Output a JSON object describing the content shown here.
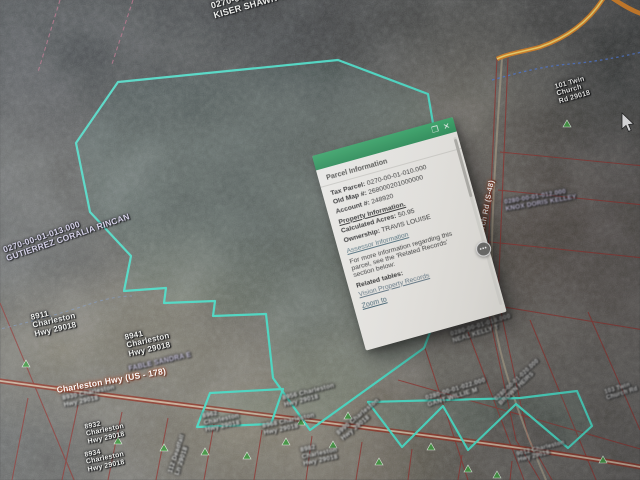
{
  "popup": {
    "title": "Parcel Information",
    "dock_icon": "❐",
    "close_icon": "✕",
    "rows": [
      {
        "label": "Tax Parcel:",
        "value": "0270-00-01-010.000"
      },
      {
        "label": "Old Map #:",
        "value": "268000201000000"
      },
      {
        "label": "Account #:",
        "value": "248920"
      }
    ],
    "property_heading": "Property Information.",
    "property_rows": [
      {
        "label": "Calculated Acres:",
        "value": "50.95"
      },
      {
        "label": "Ownership:",
        "value": "TRAVIS LOUISE"
      }
    ],
    "assessor_link": "Assessor Information",
    "note": "For more information regarding this parcel, see the 'Related Records' section below:",
    "related_heading": "Related tables:",
    "related_link": "Vision Property Records",
    "zoom_to_link": "Zoom to",
    "more_options_icon": "•••"
  },
  "map": {
    "colors": {
      "selected_parcel": "#3de3c9",
      "parcel_line": "#9c3530",
      "road_orange": "#e0811d",
      "marker_green": "#3f9e3e",
      "owner_label_purple": "#d9d2ee"
    },
    "labels": [
      {
        "lines": [
          "0270-00-01-004.000",
          "KISER SHAWN CAMPBELL"
        ]
      },
      {
        "lines": [
          "0270-00-01-013.000",
          "GUTIERREZ CORALIA RINCAN"
        ]
      },
      {
        "lines": [
          "8911",
          "Charleston",
          "Hwy 29018"
        ]
      },
      {
        "lines": [
          "8941",
          "Charleston",
          "Hwy 29018"
        ]
      },
      {
        "lines": [
          "FABLE SANDRA E"
        ]
      },
      {
        "lines": [
          "Charleston Hwy (US - 178)"
        ]
      },
      {
        "lines": [
          "8930 Charleston",
          "Hwy 29018"
        ]
      },
      {
        "lines": [
          "8932",
          "Charleston",
          "Hwy 29018"
        ]
      },
      {
        "lines": [
          "8934",
          "Charleston",
          "Hwy 29018"
        ]
      },
      {
        "lines": [
          "112 Deadfall",
          "Ln 29018"
        ]
      },
      {
        "lines": [
          "8962",
          "Charleston",
          "Hwy 29018"
        ]
      },
      {
        "lines": [
          "8968 Charleston",
          "Hwy 29018"
        ]
      },
      {
        "lines": [
          "8956 Charleston",
          "Hwy 29018"
        ]
      },
      {
        "lines": [
          "8982",
          "Charleston",
          "Hwy 29018"
        ]
      },
      {
        "lines": [
          "8990 Charleston",
          "Hwy 29018"
        ]
      },
      {
        "lines": [
          "0280-00-01-018.000",
          "NEAL KELLY T"
        ]
      },
      {
        "lines": [
          "0280-00-01-022.000",
          "GANT WILLIE M"
        ]
      },
      {
        "lines": [
          "0280-00-01-020.000",
          "BROWN HEIRS"
        ]
      },
      {
        "lines": [
          "103 Twin",
          "Church Rd"
        ]
      },
      {
        "lines": [
          "Twin Church Rd (S-48)"
        ]
      },
      {
        "lines": [
          "0280-00-01-012.000",
          "KNOX DORIS KELLEY"
        ]
      },
      {
        "lines": [
          "101 Twin",
          "Church",
          "Rd 29018"
        ]
      },
      {
        "lines": [
          "9012 Charleston",
          "Hwy 29018"
        ]
      }
    ]
  }
}
